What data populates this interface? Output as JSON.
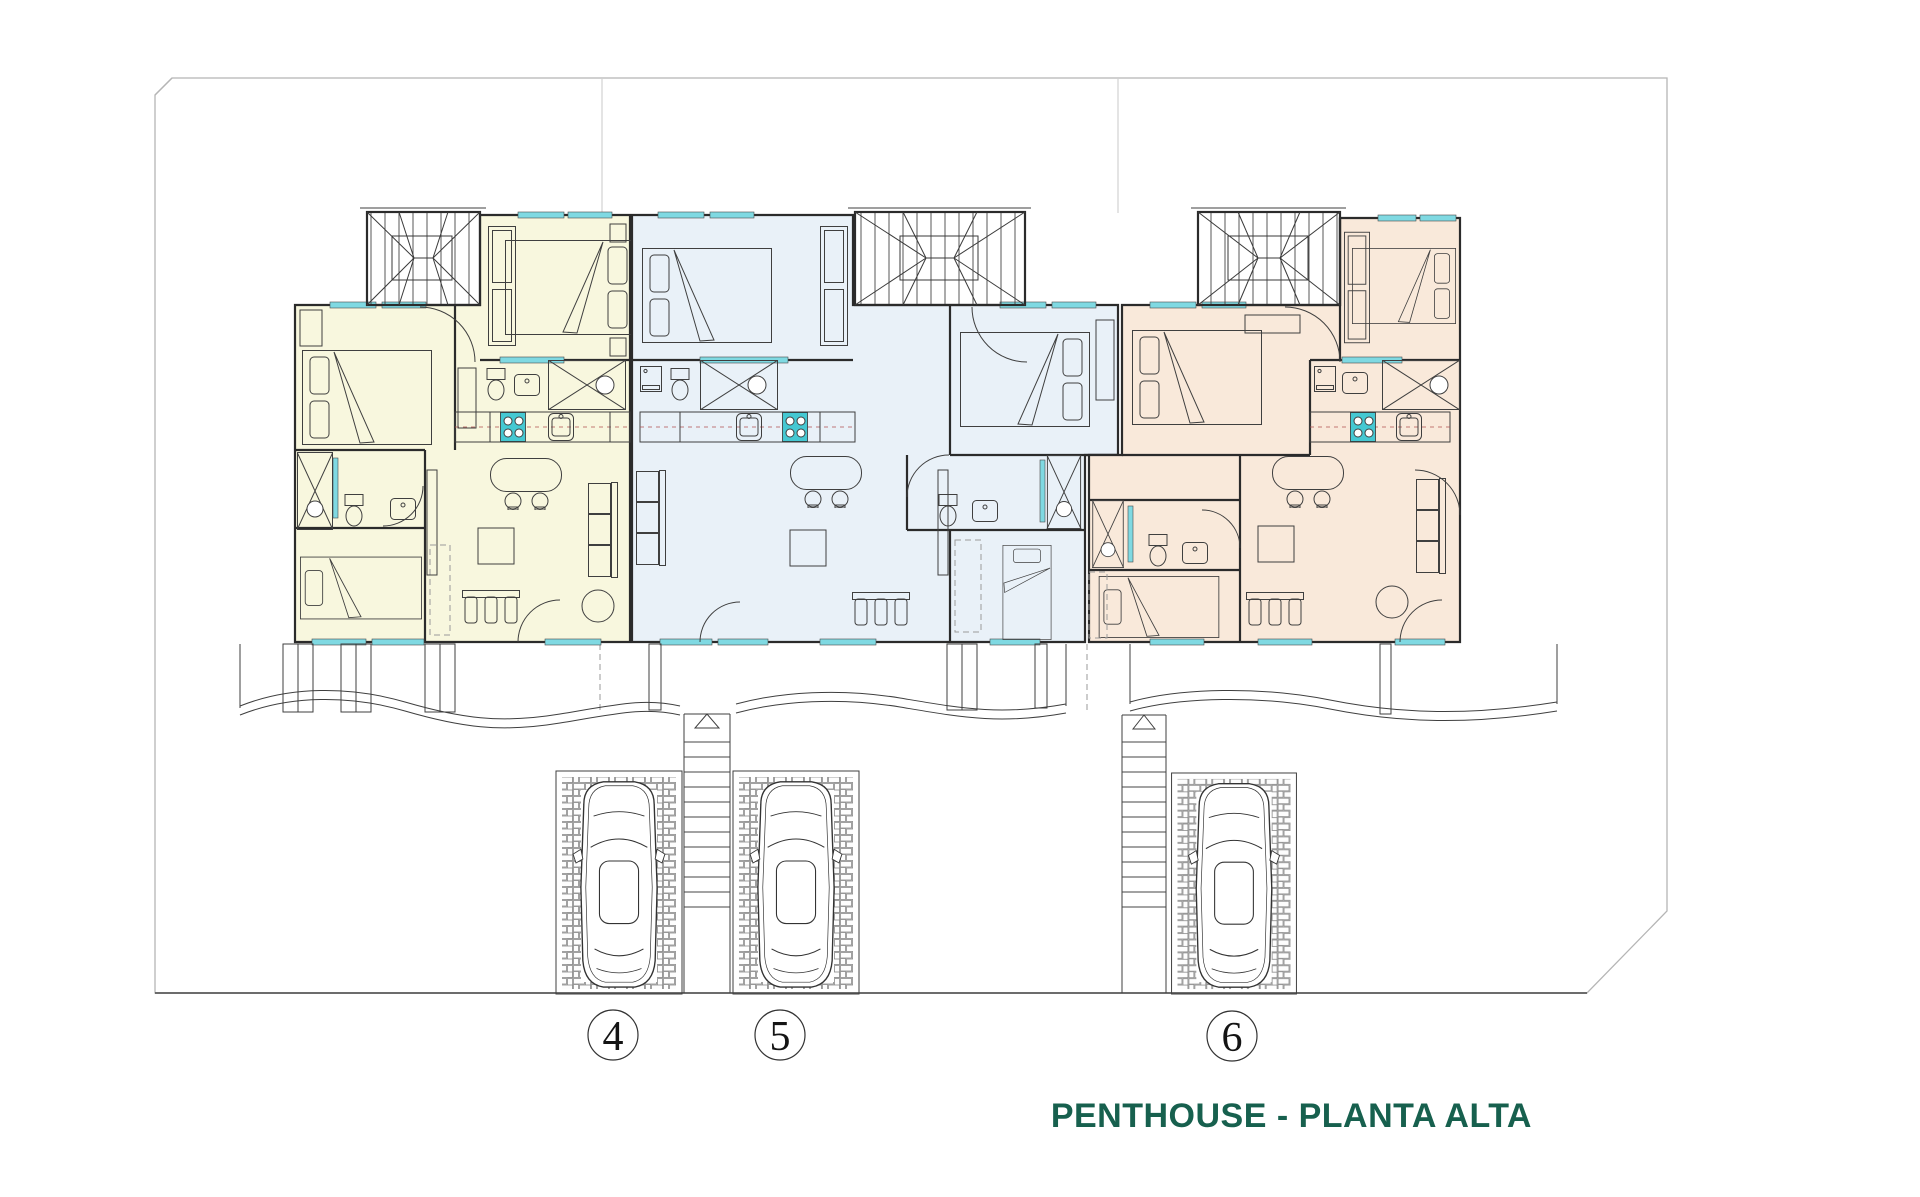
{
  "title": {
    "text": "PENTHOUSE - PLANTA ALTA",
    "color": "#17604e"
  },
  "plan": {
    "units": {
      "u4": {
        "number": "4",
        "name": "Penthouse 4",
        "color": "#f8f7de"
      },
      "u5": {
        "number": "5",
        "name": "Penthouse 5",
        "color": "#e9f1f8"
      },
      "u6": {
        "number": "6",
        "name": "Penthouse 6",
        "color": "#f9e9da"
      }
    },
    "colors": {
      "window": "#7fd9e2",
      "stove": "#45c8d2",
      "wall": "#2b2b2b",
      "furniture": "#3f3f3f",
      "boundary": "#b5b5b5",
      "ground": "#5a5a5a",
      "lot_line": "#d8d8d8",
      "brick": "#8a8a8a"
    }
  }
}
